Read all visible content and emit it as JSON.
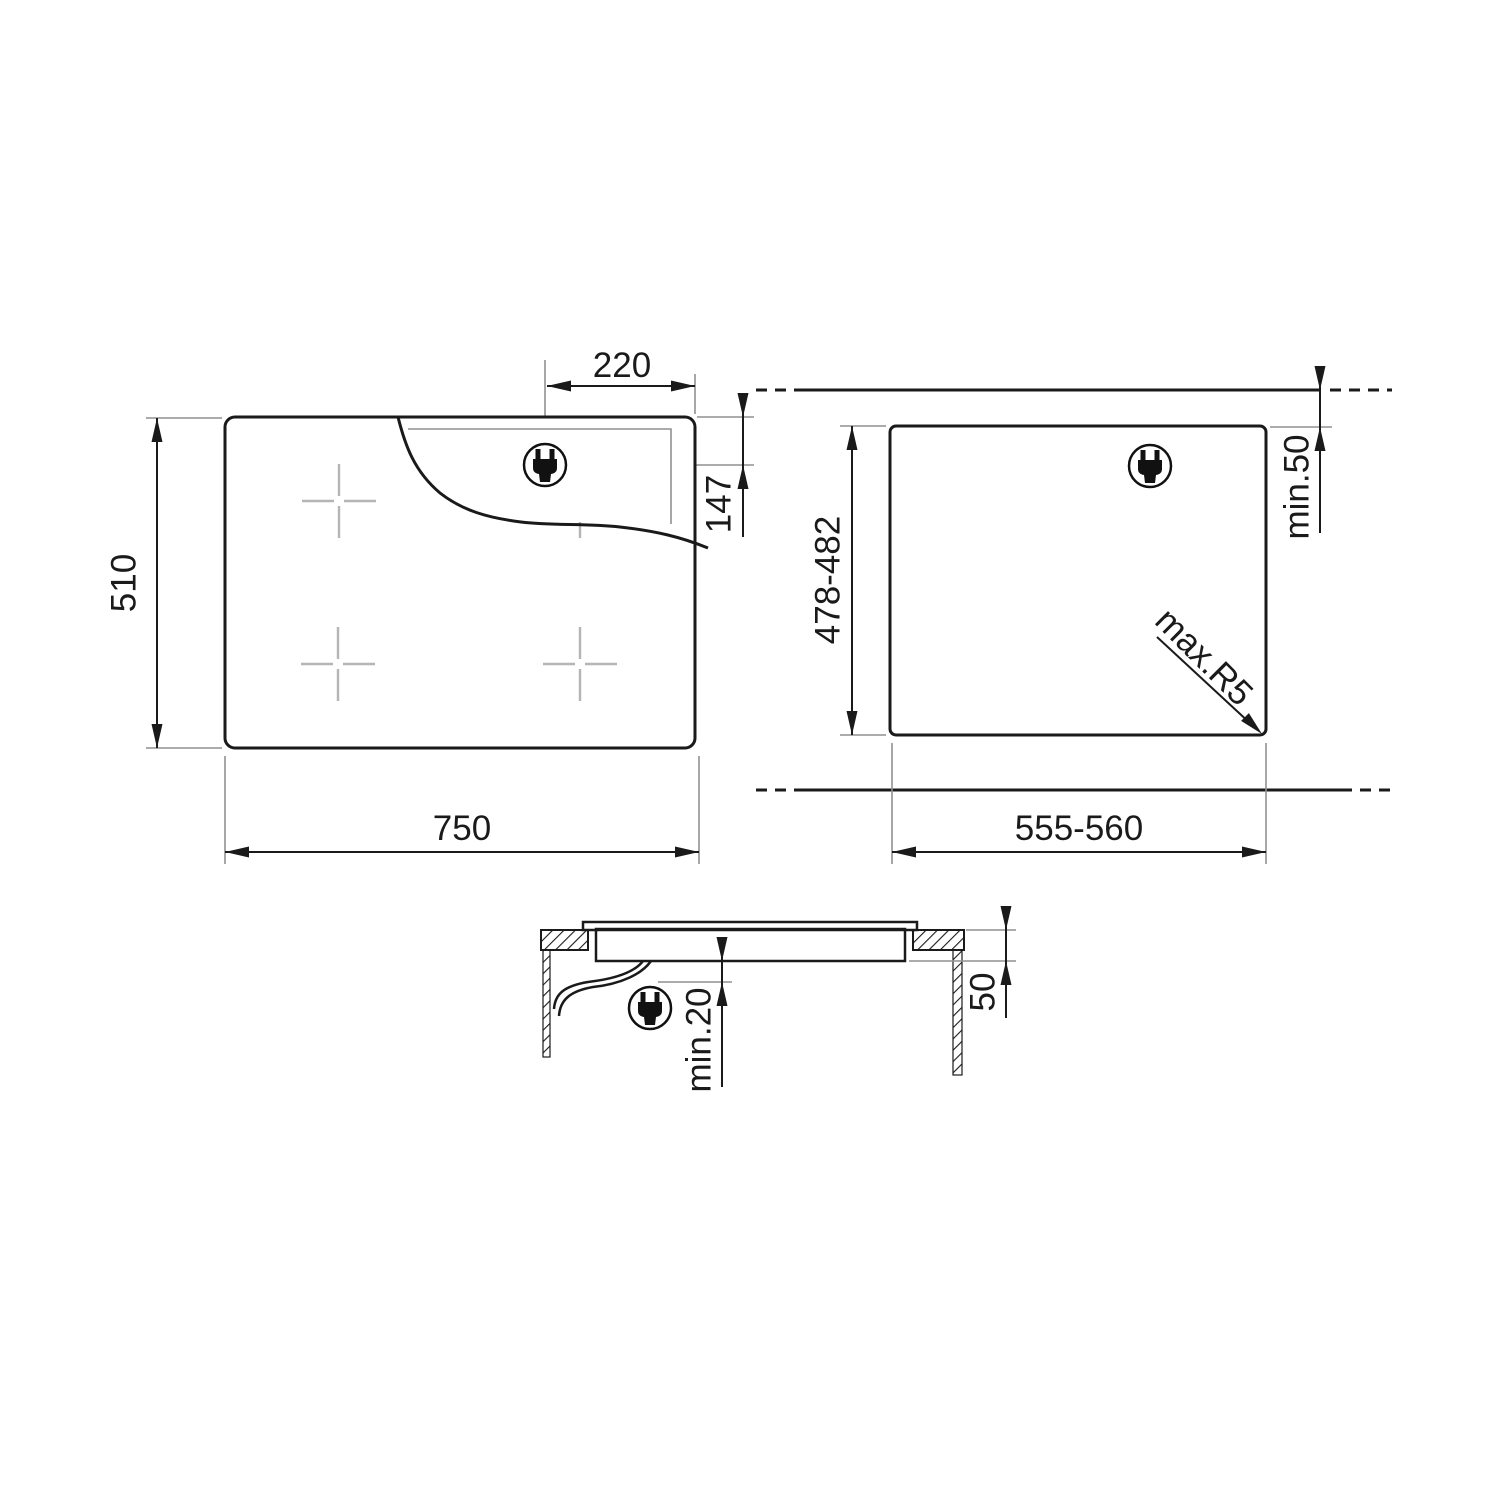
{
  "page": {
    "background": "#ffffff",
    "line_color": "#1a1a1a",
    "extension_line_color": "#919191",
    "burner_cross_color": "#b5b5b5"
  },
  "top_view": {
    "width": "750",
    "depth": "510",
    "plug_from_right": "220",
    "plug_from_rear": "147"
  },
  "cutout_view": {
    "width": "555-560",
    "depth": "478-482",
    "rear_clearance": "min.50",
    "corner_radius": "max.R5"
  },
  "section_view": {
    "clearance_below": "min.20",
    "recess_depth": "50"
  },
  "icons": {
    "plug": "power-plug-icon"
  }
}
